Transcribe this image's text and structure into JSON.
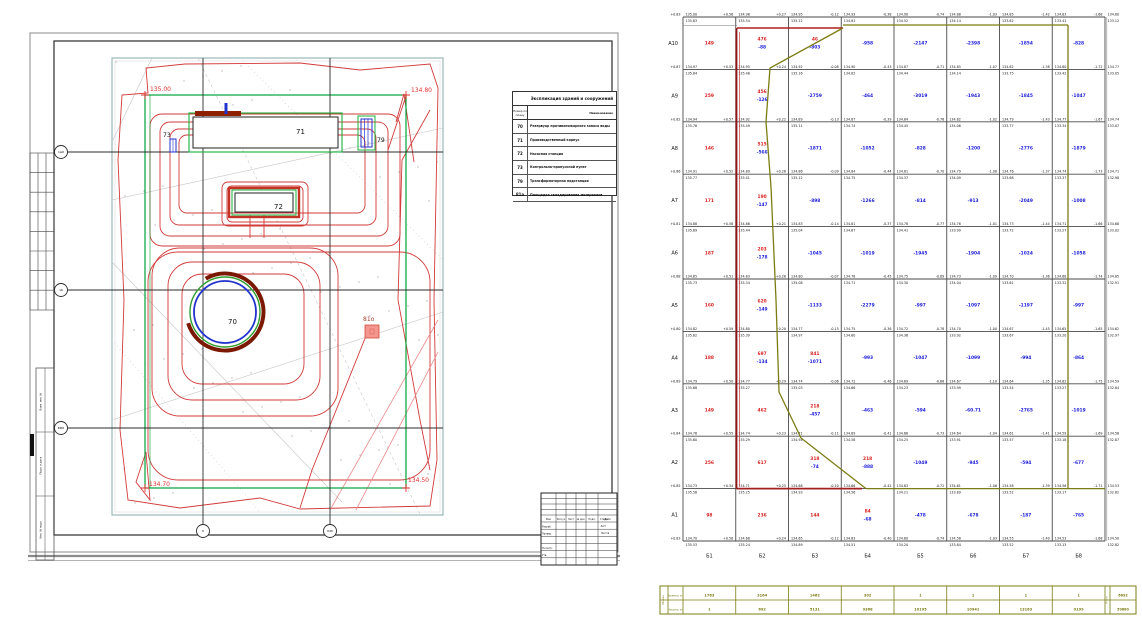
{
  "site": {
    "labels": {
      "b70": "70",
      "b71": "71",
      "b72": "72",
      "b73": "73",
      "b79": "79",
      "b81": "81о"
    },
    "elevations": {
      "tl": "135.00",
      "tr": "134.80",
      "bl": "134.70",
      "br": "134.50"
    },
    "axis_left": [
      "1мб",
      "1б",
      "БМб"
    ],
    "axis_bottom": [
      "б",
      "б4б"
    ]
  },
  "legend": {
    "title": "Экспликация зданий и сооружений",
    "col_num": "Номер по плану",
    "col_name": "Наименование",
    "rows": [
      [
        "70",
        "Резервуар противопожарного запаса воды"
      ],
      [
        "71",
        "Производственный корпус"
      ],
      [
        "72",
        "Насосная станция"
      ],
      [
        "73",
        "Контрольно-пропускной пункт"
      ],
      [
        "79",
        "Трансформаторная подстанция"
      ],
      [
        "81а",
        "Площадка складирования материалов"
      ]
    ]
  },
  "titleblock": {
    "headers": [
      "Изм.",
      "Кол.уч",
      "Лист",
      "№ док.",
      "Подп.",
      "Дата"
    ],
    "roles": [
      "Разраб.",
      "Провер.",
      "",
      "Н.контр.",
      "Утв."
    ],
    "stage": [
      "Стадия",
      "Лист",
      "Листов"
    ]
  },
  "margin": {
    "rotated": [
      "Взам. инв. №",
      "Подп. и дата",
      "Инв. № подл."
    ]
  },
  "cartogram": {
    "row_labels": [
      "А10",
      "А9",
      "А8",
      "А7",
      "А6",
      "А5",
      "А4",
      "А3",
      "А2",
      "А1"
    ],
    "col_labels": [
      "Б1",
      "Б2",
      "Б3",
      "Б4",
      "Б5",
      "Б6",
      "Б7",
      "Б8"
    ],
    "colors": {
      "cut": "#d92020",
      "fill": "#1c1cd8",
      "node": "#161616",
      "boundary": "#8e1616",
      "zero_line": "#7c7c14"
    },
    "nodes": [
      [
        "+0.83|135.00|135.83",
        "+0.56|134.98|135.54",
        "+0.27|134.95|135.22",
        "-0.12|134.93|134.81",
        "-0.38|134.90|134.52",
        "-0.74|134.88|134.14",
        "-1.03|134.85|133.82",
        "-1.42|134.83|133.41",
        "-1.68|134.80|133.12"
      ],
      [
        "+0.87|134.97|135.84",
        "+0.53|134.95|135.48",
        "+0.24|134.92|135.16",
        "-0.08|134.90|134.82",
        "-0.43|134.87|134.44",
        "-0.71|134.85|134.14",
        "-1.07|134.82|133.75",
        "-1.38|134.80|133.42",
        "-1.72|134.77|133.05"
      ],
      [
        "+0.82|134.94|135.76",
        "+0.57|134.92|135.49",
        "+0.22|134.89|135.11",
        "-0.13|134.87|134.74",
        "-0.39|134.84|134.45",
        "-0.76|134.82|134.06",
        "-1.02|134.79|133.77",
        "-1.43|134.77|133.34",
        "-1.67|134.74|133.07"
      ],
      [
        "+0.86|134.91|135.77",
        "+0.52|134.89|135.41",
        "+0.26|134.86|135.12",
        "-0.09|134.84|134.75",
        "-0.44|134.81|134.37",
        "-0.70|134.79|134.09",
        "-1.08|134.76|133.68",
        "-1.37|134.74|133.37",
        "-1.73|134.71|132.98"
      ],
      [
        "+0.81|134.88|135.69",
        "+0.58|134.86|135.44",
        "+0.21|134.83|135.04",
        "-0.14|134.81|134.67",
        "-0.37|134.78|134.41",
        "-0.77|134.76|133.99",
        "-1.01|134.73|133.72",
        "-1.44|134.71|133.27",
        "-1.66|134.68|133.02"
      ],
      [
        "+0.88|134.85|135.73",
        "+0.51|134.83|135.34",
        "+0.28|134.80|135.08",
        "-0.07|134.78|134.71",
        "-0.45|134.75|134.30",
        "-0.69|134.73|134.04",
        "-1.09|134.70|133.61",
        "-1.36|134.68|133.32",
        "-1.74|134.65|132.91"
      ],
      [
        "+0.80|134.82|135.62",
        "+0.59|134.80|135.39",
        "+0.20|134.77|134.97",
        "-0.15|134.75|134.60",
        "-0.36|134.72|134.36",
        "-0.78|134.70|133.92",
        "-1.00|134.67|133.67",
        "-1.45|134.65|133.20",
        "-1.65|134.62|132.97"
      ],
      [
        "+0.89|134.79|135.68",
        "+0.50|134.77|135.27",
        "+0.29|134.74|135.03",
        "-0.06|134.72|134.66",
        "-0.46|134.69|134.23",
        "-0.68|134.67|133.99",
        "-1.10|134.64|133.54",
        "-1.35|134.62|133.27",
        "-1.75|134.59|132.84"
      ],
      [
        "+0.84|134.76|135.60",
        "+0.55|134.74|135.29",
        "+0.23|134.71|134.94",
        "-0.11|134.69|134.58",
        "-0.41|134.66|134.25",
        "-0.73|134.64|133.91",
        "-1.04|134.61|133.57",
        "-1.41|134.59|133.18",
        "-1.69|134.56|132.87"
      ],
      [
        "+0.85|134.73|135.58",
        "+0.54|134.71|135.25",
        "+0.25|134.68|134.93",
        "-0.10|134.66|134.56",
        "-0.42|134.63|134.21",
        "-0.72|134.61|133.89",
        "-1.06|134.58|133.52",
        "-1.39|134.56|133.17",
        "-1.71|134.53|132.82"
      ],
      [
        "+0.83|134.70|135.53",
        "+0.56|134.68|135.24",
        "+0.24|134.65|134.89",
        "-0.12|134.63|134.51",
        "-0.40|134.60|134.20",
        "-0.74|134.58|133.84",
        "-1.03|134.55|133.52",
        "-1.40|134.53|133.13",
        "-1.68|134.50|132.82"
      ]
    ],
    "cells": [
      [
        {
          "r": "149"
        },
        {
          "r": "476",
          "b": "-88"
        },
        {
          "r": "46",
          "b": "-803"
        },
        {
          "b": "-958"
        },
        {
          "b": "-2147"
        },
        {
          "b": "-2398"
        },
        {
          "b": "-1854"
        },
        {
          "b": "-828"
        }
      ],
      [
        {
          "r": "259"
        },
        {
          "r": "456",
          "b": "-126"
        },
        {
          "b": "-2759"
        },
        {
          "b": "-464"
        },
        {
          "b": "-3019"
        },
        {
          "b": "-1943"
        },
        {
          "b": "-1845"
        },
        {
          "b": "-1047"
        }
      ],
      [
        {
          "r": "146"
        },
        {
          "r": "515",
          "b": "-566"
        },
        {
          "b": "-1871"
        },
        {
          "b": "-1052"
        },
        {
          "b": "-828"
        },
        {
          "b": "-1200"
        },
        {
          "b": "-2776"
        },
        {
          "b": "-1879"
        }
      ],
      [
        {
          "r": "171"
        },
        {
          "r": "190",
          "b": "-147"
        },
        {
          "b": "-898"
        },
        {
          "b": "-1266"
        },
        {
          "b": "-814"
        },
        {
          "b": "-913"
        },
        {
          "b": "-2049"
        },
        {
          "b": "-1008"
        }
      ],
      [
        {
          "r": "187"
        },
        {
          "r": "203",
          "b": "-178"
        },
        {
          "b": "-1045"
        },
        {
          "b": "-1019"
        },
        {
          "b": "-1945"
        },
        {
          "b": "-1904"
        },
        {
          "b": "-1024"
        },
        {
          "b": "-1058"
        }
      ],
      [
        {
          "r": "160"
        },
        {
          "r": "620",
          "b": "-149"
        },
        {
          "b": "-1133"
        },
        {
          "b": "-2279"
        },
        {
          "b": "-997"
        },
        {
          "b": "-1097"
        },
        {
          "b": "-1197"
        },
        {
          "b": "-997"
        }
      ],
      [
        {
          "r": "188"
        },
        {
          "r": "697",
          "b": "-134"
        },
        {
          "r": "841",
          "b": "-1071"
        },
        {
          "b": "-993"
        },
        {
          "b": "-1047"
        },
        {
          "b": "-1099"
        },
        {
          "b": "-994"
        },
        {
          "b": "-864"
        }
      ],
      [
        {
          "r": "149"
        },
        {
          "r": "462"
        },
        {
          "r": "218",
          "b": "-457"
        },
        {
          "b": "-463"
        },
        {
          "b": "-594"
        },
        {
          "b": "-60.71"
        },
        {
          "b": "-2765"
        },
        {
          "b": "-1019"
        }
      ],
      [
        {
          "r": "256"
        },
        {
          "r": "617"
        },
        {
          "r": "318",
          "b": "-74"
        },
        {
          "r": "218",
          "b": "-888"
        },
        {
          "b": "-1049"
        },
        {
          "b": "-945"
        },
        {
          "b": "-594"
        },
        {
          "b": "-677"
        }
      ],
      [
        {
          "r": "98"
        },
        {
          "r": "236"
        },
        {
          "r": "144"
        },
        {
          "r": "84",
          "b": "-68"
        },
        {
          "b": "-478"
        },
        {
          "b": "-678"
        },
        {
          "b": "-187"
        },
        {
          "b": "-765"
        }
      ]
    ]
  },
  "strip": {
    "row_labels": [
      "Выемка, м³",
      "Насыпь, м³"
    ],
    "cut": [
      "1763",
      "3164",
      "1462",
      "302",
      "1",
      "1",
      "1",
      "1"
    ],
    "fill": [
      "1",
      "692",
      "5131",
      "9368",
      "10195",
      "10941",
      "13163",
      "9199"
    ],
    "totals": [
      "6692",
      "59680"
    ],
    "left_note": "Объемы",
    "right_note": "Итого"
  }
}
